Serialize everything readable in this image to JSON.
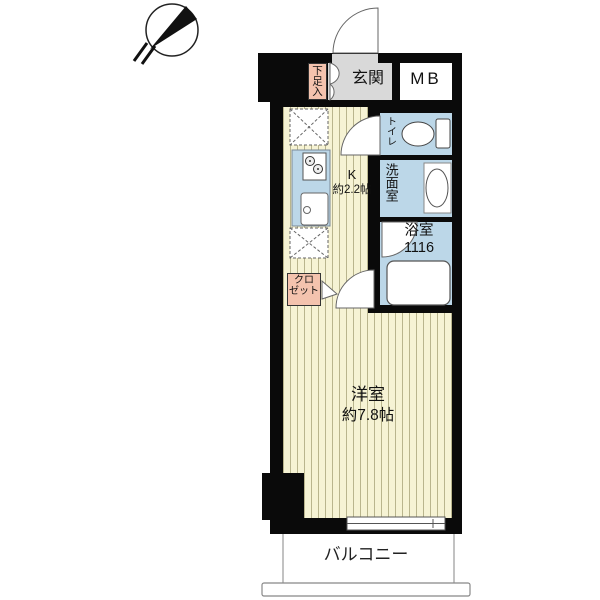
{
  "colors": {
    "wall": "#0a0a0a",
    "wood_floor": "#f6f3d4",
    "floor_stripe": "#b9b58d",
    "wet_room_blue": "#bcd7e8",
    "genkan_gray": "#d9d9d9",
    "storage_pink": "#f4c3ae",
    "fixture_outline": "#555555"
  },
  "rooms": {
    "genkan": {
      "label": "玄関"
    },
    "shoe_storage": {
      "label": "下足入"
    },
    "meter_box": {
      "label": "MB"
    },
    "toilet": {
      "label": "トイレ"
    },
    "washroom": {
      "label": "洗面室"
    },
    "bathroom": {
      "label": "浴室",
      "size": "1116"
    },
    "kitchen": {
      "label": "K",
      "size": "約2.2帖"
    },
    "closet": {
      "line1": "クロ",
      "line2": "ゼット"
    },
    "western_room": {
      "label": "洋室",
      "size": "約7.8帖"
    },
    "balcony": {
      "label": "バルコニー"
    }
  }
}
